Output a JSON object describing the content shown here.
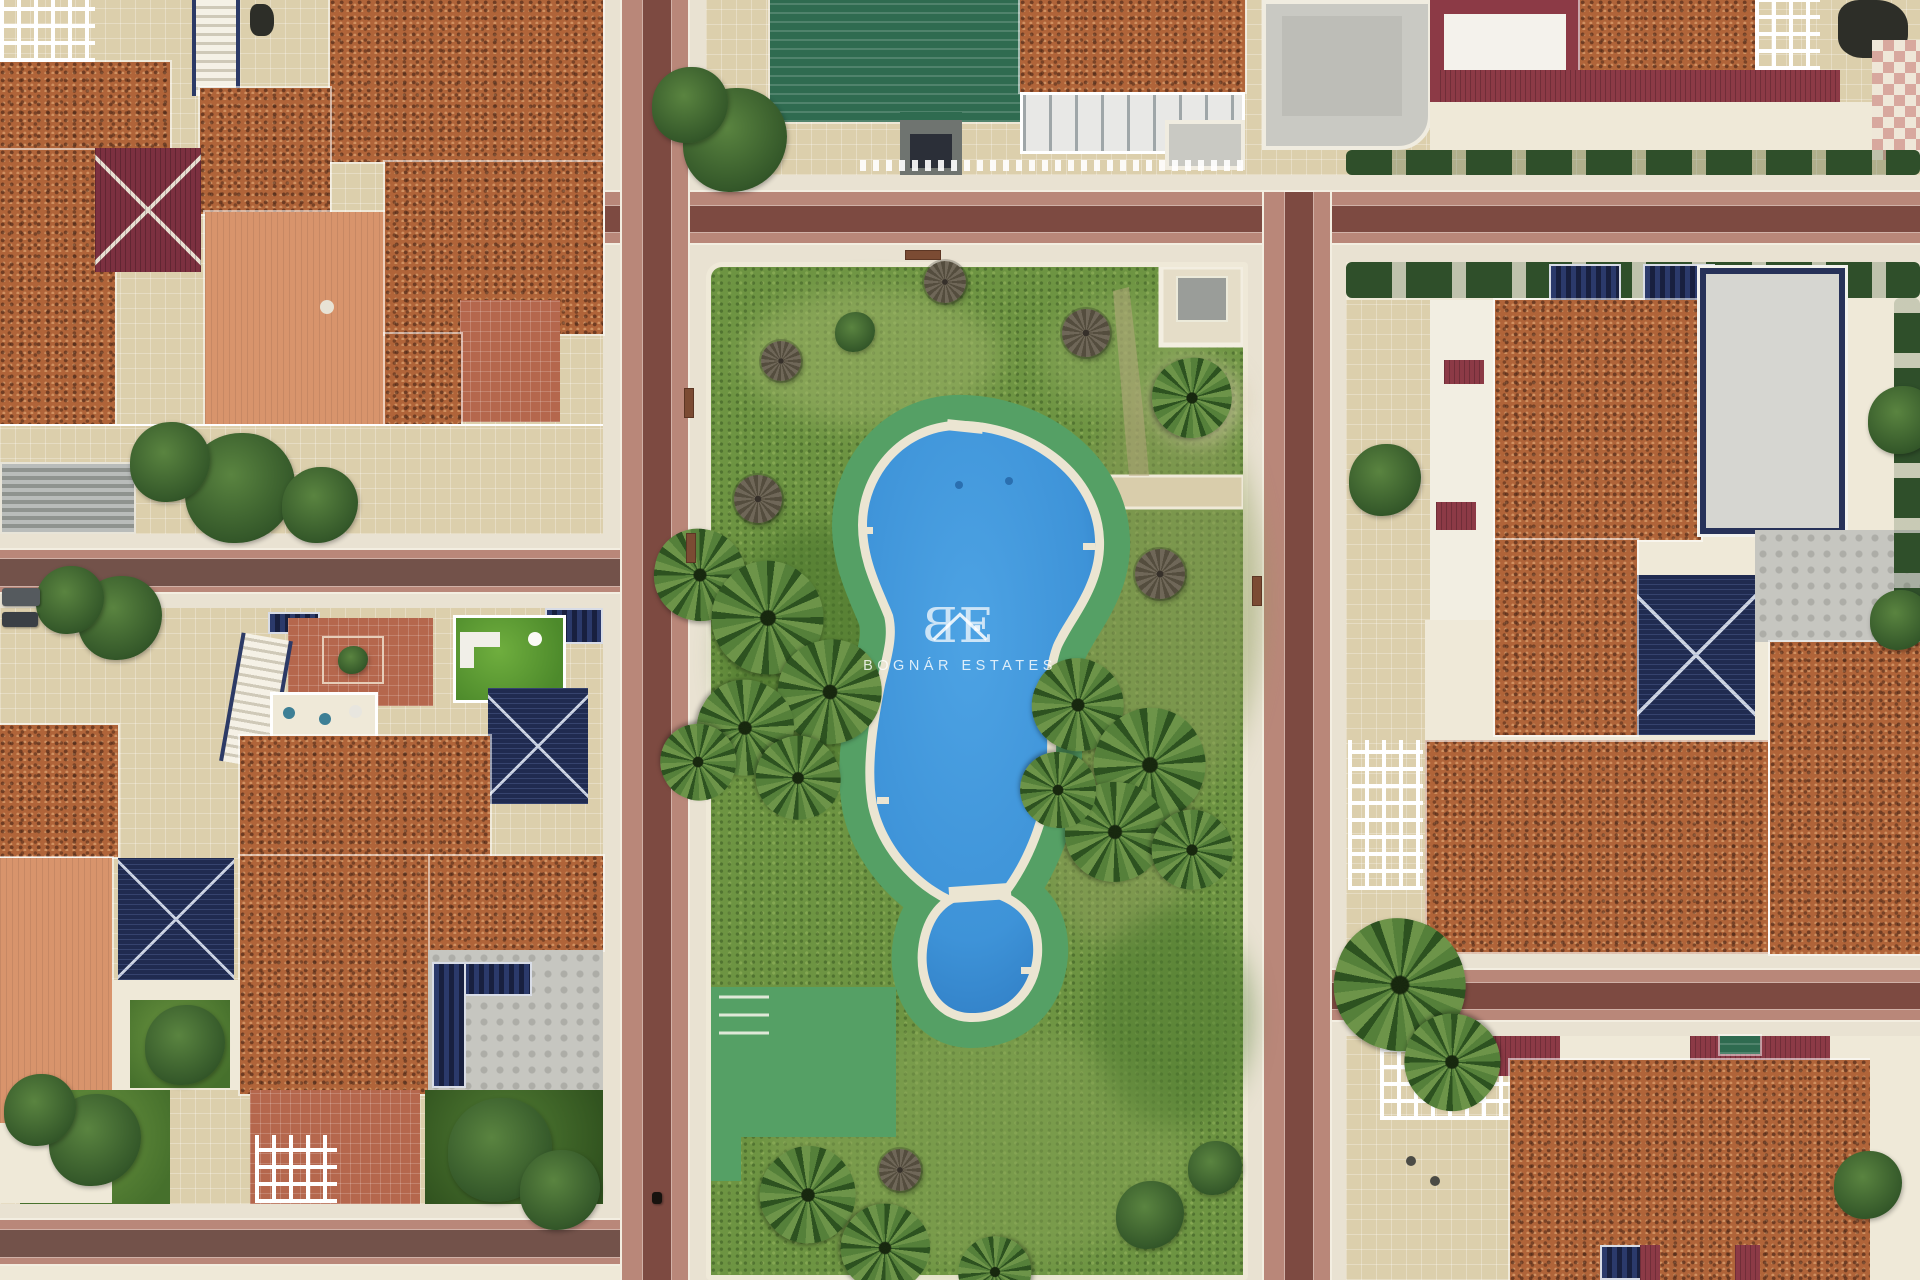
{
  "watermark": {
    "logo_b": "B",
    "logo_e": "E",
    "name": "BOGNÁR ESTATES"
  },
  "palette": {
    "grass": "#6d9442",
    "grassLight": "#92ad5f",
    "grassDark": "#4c772e",
    "grassWorn": "#9aa465",
    "poolBlue": "#3e93d8",
    "poolDeep": "#2d79c0",
    "rim": "#ebe5d2",
    "deck": "#55a065",
    "stPink": "#b98779",
    "stDark": "#7d4a41",
    "side": "#e9e2d2",
    "curb": "#f3eee1",
    "tc": "#b06439",
    "salmon": "#d8946c",
    "maroon": "#7c3040",
    "maroon2": "#8c3a46",
    "navy": "#202b50",
    "teal": "#2f6b50",
    "beige": "#dccfac",
    "brick": "#b5674d",
    "hedge": "#2f4f2a",
    "cream": "#efe9d8",
    "palm": "#4f7a33",
    "umb": "#675f50",
    "bench": "#7b4b33"
  },
  "scenery": {
    "umbrellas": [
      {
        "x": 945,
        "y": 282,
        "r": 21
      },
      {
        "x": 1086,
        "y": 333,
        "r": 24
      },
      {
        "x": 781,
        "y": 361,
        "r": 20
      },
      {
        "x": 758,
        "y": 499,
        "r": 24
      },
      {
        "x": 1160,
        "y": 574,
        "r": 25
      },
      {
        "x": 900,
        "y": 1170,
        "r": 21
      }
    ],
    "palms": [
      {
        "x": 700,
        "y": 575,
        "r": 46,
        "rot": 10
      },
      {
        "x": 768,
        "y": 618,
        "r": 56,
        "rot": 40
      },
      {
        "x": 830,
        "y": 692,
        "r": 52,
        "rot": 75
      },
      {
        "x": 745,
        "y": 728,
        "r": 48,
        "rot": 120
      },
      {
        "x": 798,
        "y": 778,
        "r": 42,
        "rot": 160
      },
      {
        "x": 698,
        "y": 762,
        "r": 38,
        "rot": 200
      },
      {
        "x": 1078,
        "y": 705,
        "r": 46,
        "rot": 25
      },
      {
        "x": 1150,
        "y": 765,
        "r": 56,
        "rot": 60
      },
      {
        "x": 1115,
        "y": 832,
        "r": 50,
        "rot": 95
      },
      {
        "x": 1192,
        "y": 850,
        "r": 40,
        "rot": 140
      },
      {
        "x": 1058,
        "y": 790,
        "r": 38,
        "rot": 185
      },
      {
        "x": 1192,
        "y": 398,
        "r": 40,
        "rot": 80
      },
      {
        "x": 1400,
        "y": 985,
        "r": 66,
        "rot": 15
      },
      {
        "x": 1452,
        "y": 1062,
        "r": 48,
        "rot": 220
      },
      {
        "x": 808,
        "y": 1195,
        "r": 48,
        "rot": 55
      },
      {
        "x": 885,
        "y": 1248,
        "r": 44,
        "rot": 130
      },
      {
        "x": 995,
        "y": 1272,
        "r": 36,
        "rot": 300
      }
    ],
    "trees": [
      {
        "x": 240,
        "y": 488,
        "r": 55
      },
      {
        "x": 170,
        "y": 462,
        "r": 40
      },
      {
        "x": 320,
        "y": 505,
        "r": 38
      },
      {
        "x": 120,
        "y": 618,
        "r": 42
      },
      {
        "x": 70,
        "y": 600,
        "r": 34
      },
      {
        "x": 95,
        "y": 1140,
        "r": 46
      },
      {
        "x": 40,
        "y": 1110,
        "r": 36
      },
      {
        "x": 185,
        "y": 1045,
        "r": 40
      },
      {
        "x": 500,
        "y": 1150,
        "r": 52
      },
      {
        "x": 560,
        "y": 1190,
        "r": 40
      },
      {
        "x": 735,
        "y": 140,
        "r": 52
      },
      {
        "x": 690,
        "y": 105,
        "r": 38
      },
      {
        "x": 1385,
        "y": 480,
        "r": 36
      },
      {
        "x": 1902,
        "y": 420,
        "r": 34
      },
      {
        "x": 1900,
        "y": 620,
        "r": 30
      },
      {
        "x": 1868,
        "y": 1185,
        "r": 34
      },
      {
        "x": 855,
        "y": 332,
        "r": 20
      },
      {
        "x": 1150,
        "y": 1215,
        "r": 34
      },
      {
        "x": 1215,
        "y": 1168,
        "r": 27
      }
    ],
    "benches": [
      {
        "x": 905,
        "y": 250,
        "w": 36,
        "h": 10
      },
      {
        "x": 684,
        "y": 388,
        "w": 10,
        "h": 30
      },
      {
        "x": 686,
        "y": 533,
        "w": 10,
        "h": 30
      },
      {
        "x": 1252,
        "y": 576,
        "w": 10,
        "h": 30
      }
    ],
    "cars": [
      {
        "x": 2,
        "y": 588,
        "w": 38,
        "h": 18,
        "c": "#555a5e"
      },
      {
        "x": 2,
        "y": 612,
        "w": 36,
        "h": 15,
        "c": "#3a3f45"
      },
      {
        "x": 652,
        "y": 1192,
        "w": 10,
        "h": 12,
        "c": "#17120e"
      }
    ]
  }
}
